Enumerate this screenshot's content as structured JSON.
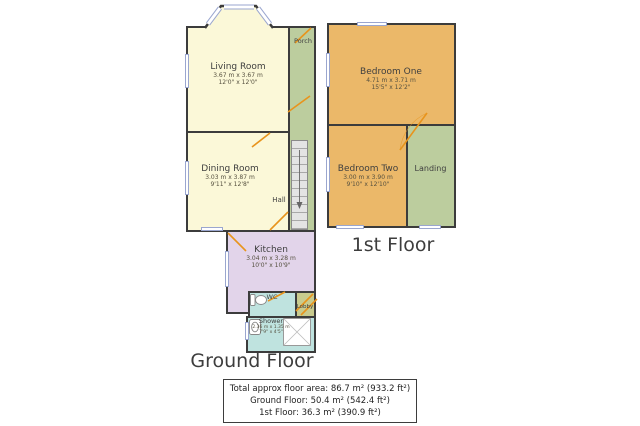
{
  "ground_floor": {
    "title": "Ground Floor",
    "rooms": {
      "living": {
        "name": "Living Room",
        "metric": "3.67 m x 3.67 m",
        "imperial": "12'0\" x 12'0\""
      },
      "dining": {
        "name": "Dining Room",
        "metric": "3.03 m x 3.87 m",
        "imperial": "9'11\" x 12'8\""
      },
      "kitchen": {
        "name": "Kitchen",
        "metric": "3.04 m x 3.28 m",
        "imperial": "10'0\" x 10'9\""
      },
      "hall": {
        "name": "Hall"
      },
      "porch": {
        "name": "Porch"
      },
      "wc": {
        "name": "WC"
      },
      "lobby": {
        "name": "Lobby"
      },
      "shower": {
        "name": "Shower",
        "metric": "2.36 m x 1.35 m",
        "imperial": "7'9\" x 4'5\""
      }
    }
  },
  "first_floor": {
    "title": "1st Floor",
    "rooms": {
      "bedroom_one": {
        "name": "Bedroom One",
        "metric": "4.71 m x 3.71 m",
        "imperial": "15'5\" x 12'2\""
      },
      "bedroom_two": {
        "name": "Bedroom Two",
        "metric": "3.00 m x 3.90 m",
        "imperial": "9'10\" x 12'10\""
      },
      "landing": {
        "name": "Landing"
      }
    }
  },
  "summary": {
    "total": "Total approx floor area: 86.7 m² (933.2 ft²)",
    "ground": "Ground Floor: 50.4 m² (542.4 ft²)",
    "first": "1st Floor: 36.3 m² (390.9 ft²)"
  },
  "palette": {
    "room_cream": "#FBF8D8",
    "hall_green": "#BCCD9E",
    "kitchen_purple": "#E2D4EA",
    "bath_teal": "#BFE3DF",
    "lobby_olive": "#C9CB8E",
    "bedroom_orange": "#EBB869",
    "wall_dark": "#3C3C3C",
    "door_orange": "#E8941C",
    "window_blue": "#9AA6CF"
  }
}
